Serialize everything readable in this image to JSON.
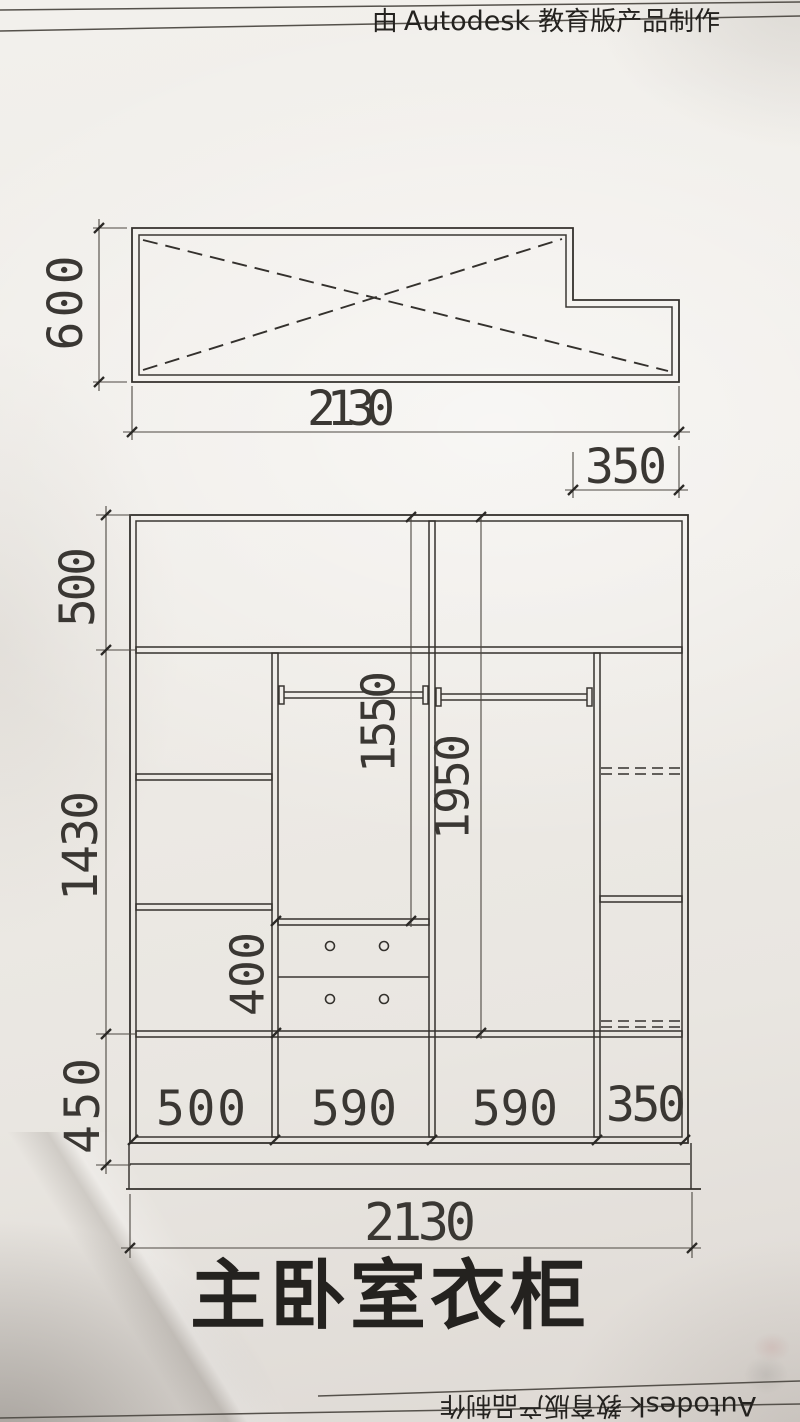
{
  "header": {
    "prefix": "由",
    "brand": "Autodesk",
    "suffix": "教育版产品制作"
  },
  "plan_view": {
    "depth": "600",
    "total_width": "2130",
    "right_section_width": "350"
  },
  "elevation": {
    "section_heights": {
      "top": "500",
      "middle": "1430",
      "bottom": "450"
    },
    "hanging_heights": {
      "left_rod": "1550",
      "right_rod": "1950"
    },
    "drawer_unit_height": "400",
    "column_widths": [
      "500",
      "590",
      "590",
      "350"
    ],
    "total_width": "2130"
  },
  "title": "主卧室衣柜",
  "footer": {
    "brand": "Autodesk",
    "suffix": "教育版产品制作"
  }
}
